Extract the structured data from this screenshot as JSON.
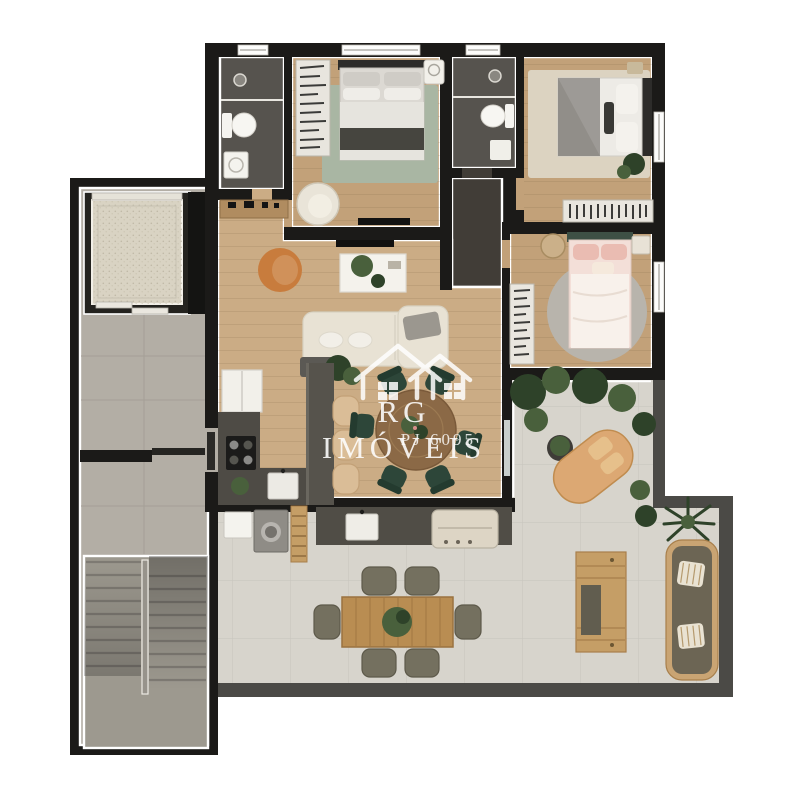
{
  "watermark": {
    "brand": "RG IMÓVEIS",
    "registration": "PJ 6095",
    "logo_icon": "twin-houses-outline-icon"
  },
  "palette": {
    "page_bg": "#ffffff",
    "wall": "#1b1a18",
    "wall_trim": "#ffffff",
    "parapet": "#4b4a46",
    "wood_floor": "#c2a179",
    "wood_floor_light": "#cbac85",
    "hall_floor": "#413d37",
    "bath_floor": "#56534e",
    "tile_corridor": "#b3aea5",
    "tile_terrace": "#d7d4cc",
    "stair_gray": "#9d998f",
    "counter_dark": "#4e4b45",
    "island_dark": "#56534c",
    "rug_green": "#a9b6a3",
    "rug_beige": "#dcd3c1",
    "rug_round": "#b8b4ac",
    "bed_white": "#edebe6",
    "bed_gray": "#92908b",
    "bed_dark_throw": "#46453f",
    "headboard_dark": "#2d2c2a",
    "bed_pink": "#f3dfd8",
    "pink_accent": "#eabcb2",
    "headboard_green": "#3e5045",
    "sofa_cream": "#e8e2d4",
    "chair_orange": "#c87c3d",
    "table_white": "#f4f2ec",
    "dining_wood": "#8b6946",
    "chair_green": "#2d4639",
    "stool_tan": "#dabd97",
    "plant_dark": "#2e4229",
    "plant_mid": "#49603c",
    "outdoor_wood": "#c59e66",
    "outdoor_olive": "#6c6554",
    "lounge_tan": "#dca873",
    "appliance_white": "#f2f0ea",
    "washer_gray": "#8f8c86",
    "grill_beige": "#ddd5c5",
    "terrace_chair": "#74705f",
    "watermark": "#ffffff"
  }
}
